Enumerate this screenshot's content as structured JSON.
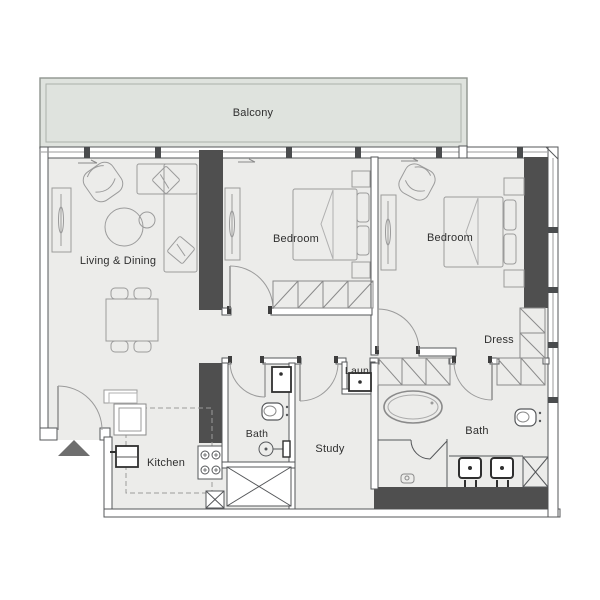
{
  "floor_plan": {
    "title": "Apartment floor plan",
    "rooms": {
      "balcony": {
        "label": "Balcony"
      },
      "living_dining": {
        "label": "Living & Dining"
      },
      "bedroom_1": {
        "label": "Bedroom"
      },
      "bedroom_2": {
        "label": "Bedroom"
      },
      "dress": {
        "label": "Dress"
      },
      "bath_1": {
        "label": "Bath"
      },
      "bath_2": {
        "label": "Bath"
      },
      "study": {
        "label": "Study"
      },
      "kitchen": {
        "label": "Kitchen"
      },
      "laundry": {
        "label": "Laun"
      }
    },
    "colors": {
      "floor": "#ECECEA",
      "balcony_fill": "#DFE3DE",
      "wall_outline": "#55575A",
      "column_fill": "#4F4F4F",
      "furniture_line": "#9B9B9B",
      "fixture_line": "#2F2F2F",
      "text": "#2F2F2F",
      "entry_arrow_fill": "#6E6E6E"
    },
    "icons": {
      "entry_arrow": "triangle-up",
      "door_swing": "quarter-arc",
      "wardrobe": "rect-with-diagonal",
      "shaft": "rect-with-x",
      "bathtub": "double-oval",
      "stove": "four-burner-circles",
      "washer": "bold-square-with-dot",
      "sink": "bold-square-with-dot",
      "toilet": "rounded-rect-with-oval",
      "window_arrow": "right-arrow"
    }
  }
}
